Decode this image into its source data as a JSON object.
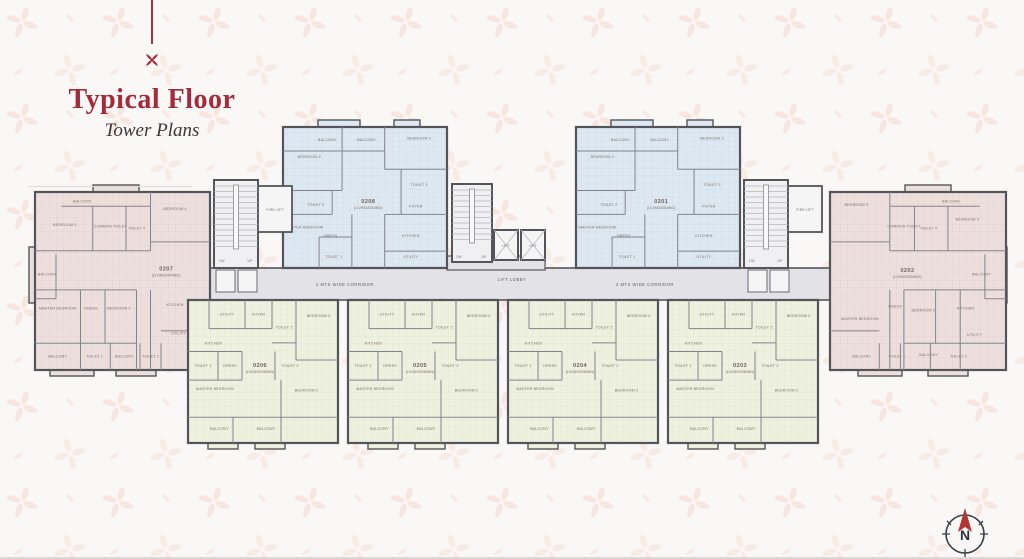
{
  "page": {
    "background": "#faf8f6",
    "accent_red": "#a32b3a",
    "wall_color": "#54555b",
    "corridor_fill": "#e3e3e7",
    "unit_fills": {
      "blue": "#dde8f1",
      "pink": "#ecdfdd",
      "yellow": "#eef0e0"
    }
  },
  "header": {
    "title": "Typical Floor",
    "subtitle": "Tower Plans"
  },
  "corridor": {
    "label_left": "2 MTS WIDE CORRIDOR",
    "label_right": "2 MTS WIDE CORRIDOR",
    "lift_lobby": "LIFT LOBBY"
  },
  "cores": {
    "lift_1": "LIFT",
    "lift_2": "LIFT",
    "fire_lift_left": "FIRE LIFT",
    "fire_lift_right": "FIRE LIFT",
    "dn_left": "DN",
    "up_left": "UP",
    "dn_center": "DN",
    "up_center": "UP",
    "dn_right": "DN",
    "up_right": "UP"
  },
  "compass": {
    "label": "N"
  },
  "units": [
    {
      "id": "0207",
      "suffix": "(LIVING/DINING)",
      "palette": "pink",
      "label_pos": [
        0.75,
        0.44
      ],
      "rooms": [
        {
          "label": "BALCONY",
          "x": 0.27,
          "y": 0.06
        },
        {
          "label": "BEDROOM 3",
          "x": 0.17,
          "y": 0.19
        },
        {
          "label": "COMMON TOILET",
          "x": 0.43,
          "y": 0.2
        },
        {
          "label": "TOILET 4",
          "x": 0.58,
          "y": 0.21
        },
        {
          "label": "BEDROOM 4",
          "x": 0.8,
          "y": 0.1
        },
        {
          "label": "BALCONY",
          "x": 0.07,
          "y": 0.47
        },
        {
          "label": "MASTER BEDROOM",
          "x": 0.13,
          "y": 0.66
        },
        {
          "label": "DRESS",
          "x": 0.32,
          "y": 0.66
        },
        {
          "label": "BEDROOM 2",
          "x": 0.48,
          "y": 0.66
        },
        {
          "label": "KITCHEN",
          "x": 0.8,
          "y": 0.64
        },
        {
          "label": "UTILITY",
          "x": 0.82,
          "y": 0.8
        },
        {
          "label": "BALCONY",
          "x": 0.13,
          "y": 0.93
        },
        {
          "label": "TOILET 1",
          "x": 0.34,
          "y": 0.93
        },
        {
          "label": "BALCONY",
          "x": 0.51,
          "y": 0.93
        },
        {
          "label": "TOILET 2",
          "x": 0.66,
          "y": 0.93
        }
      ]
    },
    {
      "id": "0208",
      "suffix": "(LIVING/DINING)",
      "palette": "blue",
      "label_pos": [
        0.52,
        0.54
      ],
      "rooms": [
        {
          "label": "BALCONY",
          "x": 0.27,
          "y": 0.1
        },
        {
          "label": "BALCONY",
          "x": 0.51,
          "y": 0.1
        },
        {
          "label": "BEDROOM 3",
          "x": 0.83,
          "y": 0.09
        },
        {
          "label": "BEDROOM 2",
          "x": 0.16,
          "y": 0.22
        },
        {
          "label": "TOILET 3",
          "x": 0.83,
          "y": 0.42
        },
        {
          "label": "TOILET 2",
          "x": 0.2,
          "y": 0.56
        },
        {
          "label": "FOYER",
          "x": 0.81,
          "y": 0.57
        },
        {
          "label": "MASTER BEDROOM",
          "x": 0.13,
          "y": 0.72
        },
        {
          "label": "DRESS",
          "x": 0.29,
          "y": 0.78
        },
        {
          "label": "KITCHEN",
          "x": 0.78,
          "y": 0.78
        },
        {
          "label": "TOILET 1",
          "x": 0.31,
          "y": 0.93
        },
        {
          "label": "UTILITY",
          "x": 0.78,
          "y": 0.93
        }
      ]
    },
    {
      "id": "0201",
      "suffix": "(LIVING/DINING)",
      "palette": "blue",
      "label_pos": [
        0.52,
        0.54
      ],
      "rooms": [
        {
          "label": "BALCONY",
          "x": 0.27,
          "y": 0.1
        },
        {
          "label": "BALCONY",
          "x": 0.51,
          "y": 0.1
        },
        {
          "label": "BEDROOM 3",
          "x": 0.83,
          "y": 0.09
        },
        {
          "label": "BEDROOM 2",
          "x": 0.16,
          "y": 0.22
        },
        {
          "label": "TOILET 3",
          "x": 0.83,
          "y": 0.42
        },
        {
          "label": "TOILET 2",
          "x": 0.2,
          "y": 0.56
        },
        {
          "label": "FOYER",
          "x": 0.81,
          "y": 0.57
        },
        {
          "label": "MASTER BEDROOM",
          "x": 0.13,
          "y": 0.72
        },
        {
          "label": "DRESS",
          "x": 0.29,
          "y": 0.78
        },
        {
          "label": "KITCHEN",
          "x": 0.78,
          "y": 0.78
        },
        {
          "label": "TOILET 1",
          "x": 0.31,
          "y": 0.93
        },
        {
          "label": "UTILITY",
          "x": 0.78,
          "y": 0.93
        }
      ]
    },
    {
      "id": "0202",
      "suffix": "(LIVING/DINING)",
      "palette": "pinkm",
      "label_pos": [
        0.44,
        0.45
      ],
      "rooms": [
        {
          "label": "BEDROOM 3",
          "x": 0.15,
          "y": 0.08
        },
        {
          "label": "BALCONY",
          "x": 0.69,
          "y": 0.06
        },
        {
          "label": "COMMON TOILET",
          "x": 0.42,
          "y": 0.2
        },
        {
          "label": "TOILET 4",
          "x": 0.56,
          "y": 0.21
        },
        {
          "label": "BEDROOM 4",
          "x": 0.78,
          "y": 0.16
        },
        {
          "label": "BALCONY",
          "x": 0.86,
          "y": 0.47
        },
        {
          "label": "MASTER BEDROOM",
          "x": 0.17,
          "y": 0.72
        },
        {
          "label": "DRESS",
          "x": 0.37,
          "y": 0.65
        },
        {
          "label": "BEDROOM 2",
          "x": 0.53,
          "y": 0.67
        },
        {
          "label": "KITCHEN",
          "x": 0.77,
          "y": 0.66
        },
        {
          "label": "UTILITY",
          "x": 0.82,
          "y": 0.81
        },
        {
          "label": "BALCONY",
          "x": 0.18,
          "y": 0.93
        },
        {
          "label": "TOILET 1",
          "x": 0.38,
          "y": 0.93
        },
        {
          "label": "BALCONY",
          "x": 0.56,
          "y": 0.92
        },
        {
          "label": "TOILET 2",
          "x": 0.73,
          "y": 0.93
        }
      ]
    },
    {
      "id": "0206",
      "suffix": "(LIVING/DINING)",
      "palette": "yellow",
      "label_pos": [
        0.48,
        0.47
      ],
      "rooms": [
        {
          "label": "UTILITY",
          "x": 0.26,
          "y": 0.11
        },
        {
          "label": "FOYER",
          "x": 0.47,
          "y": 0.11
        },
        {
          "label": "TOILET 3",
          "x": 0.64,
          "y": 0.2
        },
        {
          "label": "BEDROOM 3",
          "x": 0.87,
          "y": 0.12
        },
        {
          "label": "KITCHEN",
          "x": 0.17,
          "y": 0.31
        },
        {
          "label": "TOILET 1",
          "x": 0.1,
          "y": 0.47
        },
        {
          "label": "DRESS",
          "x": 0.28,
          "y": 0.47
        },
        {
          "label": "TOILET 2",
          "x": 0.68,
          "y": 0.47
        },
        {
          "label": "MASTER BEDROOM",
          "x": 0.18,
          "y": 0.63
        },
        {
          "label": "BEDROOM 2",
          "x": 0.79,
          "y": 0.64
        },
        {
          "label": "BALCONY",
          "x": 0.21,
          "y": 0.91
        },
        {
          "label": "BALCONY",
          "x": 0.52,
          "y": 0.91
        }
      ]
    },
    {
      "id": "0205",
      "suffix": "(LIVING/DINING)",
      "palette": "yellow",
      "label_pos": [
        0.48,
        0.47
      ],
      "rooms": [
        {
          "label": "UTILITY",
          "x": 0.26,
          "y": 0.11
        },
        {
          "label": "FOYER",
          "x": 0.47,
          "y": 0.11
        },
        {
          "label": "TOILET 3",
          "x": 0.64,
          "y": 0.2
        },
        {
          "label": "BEDROOM 3",
          "x": 0.87,
          "y": 0.12
        },
        {
          "label": "KITCHEN",
          "x": 0.17,
          "y": 0.31
        },
        {
          "label": "TOILET 1",
          "x": 0.1,
          "y": 0.47
        },
        {
          "label": "DRESS",
          "x": 0.28,
          "y": 0.47
        },
        {
          "label": "TOILET 2",
          "x": 0.68,
          "y": 0.47
        },
        {
          "label": "MASTER BEDROOM",
          "x": 0.18,
          "y": 0.63
        },
        {
          "label": "BEDROOM 2",
          "x": 0.79,
          "y": 0.64
        },
        {
          "label": "BALCONY",
          "x": 0.21,
          "y": 0.91
        },
        {
          "label": "BALCONY",
          "x": 0.52,
          "y": 0.91
        }
      ]
    },
    {
      "id": "0204",
      "suffix": "(LIVING/DINING)",
      "palette": "yellow",
      "label_pos": [
        0.48,
        0.47
      ],
      "rooms": [
        {
          "label": "UTILITY",
          "x": 0.26,
          "y": 0.11
        },
        {
          "label": "FOYER",
          "x": 0.47,
          "y": 0.11
        },
        {
          "label": "TOILET 3",
          "x": 0.64,
          "y": 0.2
        },
        {
          "label": "BEDROOM 3",
          "x": 0.87,
          "y": 0.12
        },
        {
          "label": "KITCHEN",
          "x": 0.17,
          "y": 0.31
        },
        {
          "label": "TOILET 1",
          "x": 0.1,
          "y": 0.47
        },
        {
          "label": "DRESS",
          "x": 0.28,
          "y": 0.47
        },
        {
          "label": "TOILET 2",
          "x": 0.68,
          "y": 0.47
        },
        {
          "label": "MASTER BEDROOM",
          "x": 0.18,
          "y": 0.63
        },
        {
          "label": "BEDROOM 2",
          "x": 0.79,
          "y": 0.64
        },
        {
          "label": "BALCONY",
          "x": 0.21,
          "y": 0.91
        },
        {
          "label": "BALCONY",
          "x": 0.52,
          "y": 0.91
        }
      ]
    },
    {
      "id": "0203",
      "suffix": "(LIVING/DINING)",
      "palette": "yellow",
      "label_pos": [
        0.48,
        0.47
      ],
      "rooms": [
        {
          "label": "UTILITY",
          "x": 0.26,
          "y": 0.11
        },
        {
          "label": "FOYER",
          "x": 0.47,
          "y": 0.11
        },
        {
          "label": "TOILET 3",
          "x": 0.64,
          "y": 0.2
        },
        {
          "label": "BEDROOM 3",
          "x": 0.87,
          "y": 0.12
        },
        {
          "label": "KITCHEN",
          "x": 0.17,
          "y": 0.31
        },
        {
          "label": "TOILET 1",
          "x": 0.1,
          "y": 0.47
        },
        {
          "label": "DRESS",
          "x": 0.28,
          "y": 0.47
        },
        {
          "label": "TOILET 2",
          "x": 0.68,
          "y": 0.47
        },
        {
          "label": "MASTER BEDROOM",
          "x": 0.18,
          "y": 0.63
        },
        {
          "label": "BEDROOM 2",
          "x": 0.79,
          "y": 0.64
        },
        {
          "label": "BALCONY",
          "x": 0.21,
          "y": 0.91
        },
        {
          "label": "BALCONY",
          "x": 0.52,
          "y": 0.91
        }
      ]
    }
  ]
}
